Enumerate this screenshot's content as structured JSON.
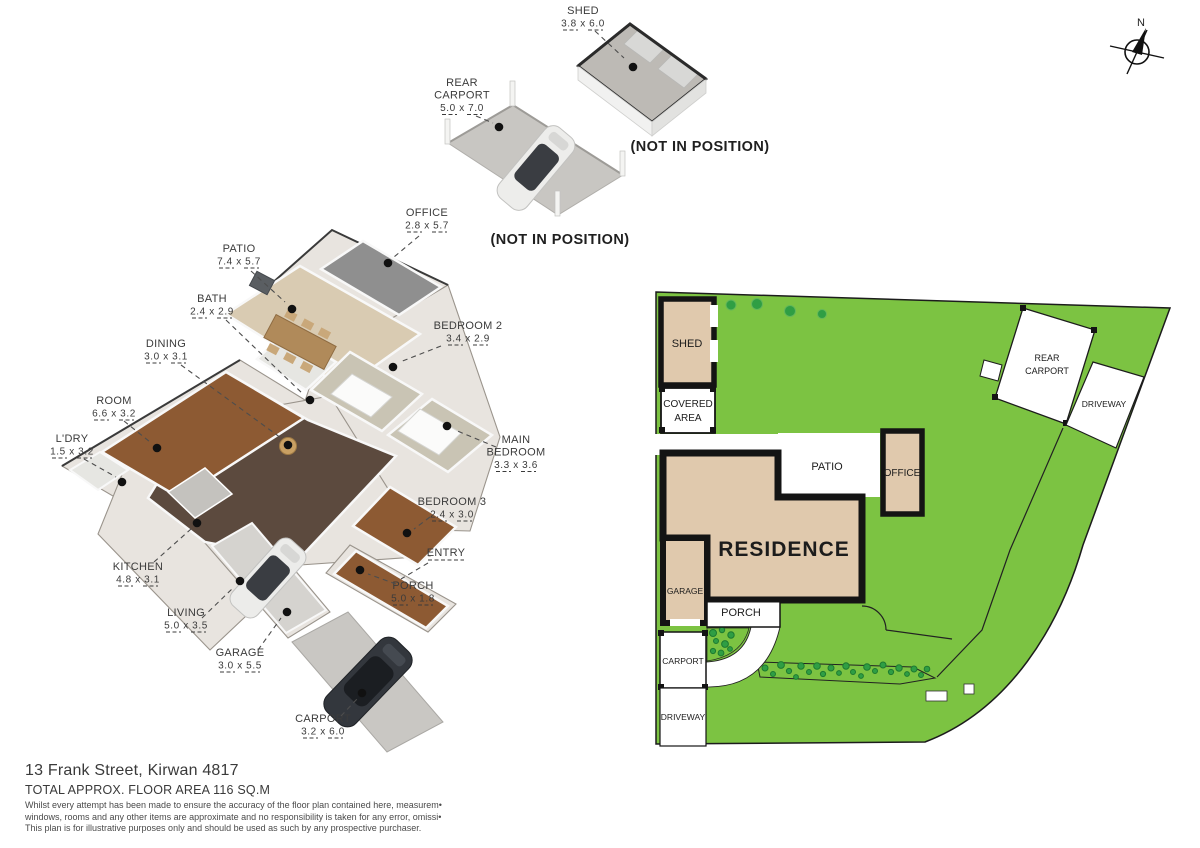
{
  "title_block": {
    "address": "13 Frank Street, Kirwan 4817",
    "floor_area": "TOTAL APPROX. FLOOR AREA 116 SQ.M",
    "disclaimer_lines": [
      "Whilst every attempt has been made to ensure the accuracy of the floor plan contained here, measurem•",
      "windows, rooms and any other items are approximate and no responsibility is taken for any error, omissi•",
      "This plan is for illustrative purposes only and should be used as such by any prospective purchaser."
    ]
  },
  "compass": {
    "label": "N"
  },
  "annotations": {
    "not_in_position_shed": "(NOT IN POSITION)",
    "not_in_position_carport": "(NOT IN POSITION)"
  },
  "floorplan_3d": {
    "labels": [
      {
        "id": "shed",
        "lines": [
          "SHED"
        ],
        "dim": "3.8 x 6.0",
        "x": 583,
        "y": 14,
        "leader": [
          595,
          31,
          624,
          58
        ],
        "dot": [
          633,
          67
        ]
      },
      {
        "id": "rear-carport",
        "lines": [
          "REAR",
          "CARPORT"
        ],
        "dim": "5.0 x 7.0",
        "x": 462,
        "y": 86,
        "leader": [
          476,
          116,
          493,
          123
        ],
        "dot": [
          499,
          127
        ]
      },
      {
        "id": "office",
        "lines": [
          "OFFICE"
        ],
        "dim": "2.8 x 5.7",
        "x": 427,
        "y": 216,
        "leader": [
          419,
          236,
          394,
          257
        ],
        "dot": [
          388,
          263
        ]
      },
      {
        "id": "patio",
        "lines": [
          "PATIO"
        ],
        "dim": "7.4 x 5.7",
        "x": 239,
        "y": 252,
        "leader": [
          251,
          271,
          285,
          302
        ],
        "dot": [
          292,
          309
        ]
      },
      {
        "id": "bath",
        "lines": [
          "BATH"
        ],
        "dim": "2.4 x 2.9",
        "x": 212,
        "y": 302,
        "leader": [
          226,
          320,
          303,
          394
        ],
        "dot": [
          310,
          400
        ]
      },
      {
        "id": "dining",
        "lines": [
          "DINING"
        ],
        "dim": "3.0 x 3.1",
        "x": 166,
        "y": 347,
        "leader": [
          181,
          365,
          281,
          438
        ],
        "dot": [
          288,
          445
        ]
      },
      {
        "id": "bedroom2",
        "lines": [
          "BEDROOM 2"
        ],
        "dim": "3.4 x 2.9",
        "x": 468,
        "y": 329,
        "leader": [
          441,
          346,
          400,
          362
        ],
        "dot": [
          393,
          367
        ]
      },
      {
        "id": "room",
        "lines": [
          "ROOM"
        ],
        "dim": "6.6 x 3.2",
        "x": 114,
        "y": 404,
        "leader": [
          124,
          421,
          150,
          442
        ],
        "dot": [
          157,
          448
        ]
      },
      {
        "id": "ldry",
        "lines": [
          "L'DRY"
        ],
        "dim": "1.5 x 3.2",
        "x": 72,
        "y": 442,
        "leader": [
          84,
          459,
          116,
          477
        ],
        "dot": [
          122,
          482
        ]
      },
      {
        "id": "main-bedroom",
        "lines": [
          "MAIN",
          "BEDROOM"
        ],
        "dim": "3.3 x 3.6",
        "x": 516,
        "y": 443,
        "leader": [
          496,
          447,
          455,
          430
        ],
        "dot": [
          447,
          426
        ]
      },
      {
        "id": "bedroom3",
        "lines": [
          "BEDROOM 3"
        ],
        "dim": "2.4 x 3.0",
        "x": 452,
        "y": 505,
        "leader": [
          430,
          517,
          414,
          529
        ],
        "dot": [
          407,
          533
        ]
      },
      {
        "id": "entry",
        "lines": [
          "ENTRY"
        ],
        "dim": null,
        "underline": true,
        "x": 446,
        "y": 556,
        "leader": [
          428,
          563,
          401,
          579
        ],
        "dot": null
      },
      {
        "id": "porch",
        "lines": [
          "PORCH"
        ],
        "dim": "5.0 x 1.8",
        "x": 413,
        "y": 589,
        "leader": [
          396,
          584,
          368,
          574
        ],
        "dot": [
          360,
          570
        ]
      },
      {
        "id": "kitchen",
        "lines": [
          "KITCHEN"
        ],
        "dim": "4.8 x 3.1",
        "x": 138,
        "y": 570,
        "leader": [
          154,
          562,
          191,
          529
        ],
        "dot": [
          197,
          523
        ]
      },
      {
        "id": "living",
        "lines": [
          "LIVING"
        ],
        "dim": "5.0 x 3.5",
        "x": 186,
        "y": 616,
        "leader": [
          202,
          618,
          234,
          587
        ],
        "dot": [
          240,
          581
        ]
      },
      {
        "id": "garage",
        "lines": [
          "GARAGE"
        ],
        "dim": "3.0 x 5.5",
        "x": 240,
        "y": 656,
        "leader": [
          258,
          650,
          281,
          618
        ],
        "dot": [
          287,
          612
        ]
      },
      {
        "id": "carport",
        "lines": [
          "CARPORT"
        ],
        "dim": "3.2 x 6.0",
        "x": 323,
        "y": 722,
        "leader": [
          341,
          716,
          357,
          699
        ],
        "dot": [
          362,
          693
        ]
      }
    ]
  },
  "site_plan": {
    "labels": {
      "shed": "SHED",
      "covered_area": [
        "COVERED",
        "AREA"
      ],
      "patio": "PATIO",
      "office": "OFFICE",
      "residence": "RESIDENCE",
      "garage": "GARAGE",
      "porch": "PORCH",
      "carport": "CARPORT",
      "driveway": "DRIVEWAY",
      "rear_carport": [
        "REAR",
        "CARPORT"
      ],
      "rear_driveway": "DRIVEWAY"
    },
    "colors": {
      "lawn": "#7cc342",
      "building": "#e0c9ad",
      "outline": "#141414"
    },
    "tree_dots": [
      [
        731,
        305,
        5
      ],
      [
        757,
        304,
        5.5
      ],
      [
        790,
        311,
        5.5
      ],
      [
        822,
        314,
        4.5
      ]
    ],
    "front_garden_dots": [
      [
        713,
        633,
        3.5
      ],
      [
        722,
        630,
        2.7
      ],
      [
        731,
        635,
        3.2
      ],
      [
        716,
        641,
        2.5
      ],
      [
        725,
        644,
        3.4
      ],
      [
        713,
        651,
        2.6
      ],
      [
        721,
        653,
        2.9
      ],
      [
        730,
        649,
        2.4
      ]
    ],
    "garden_dots": [
      [
        765,
        668,
        3
      ],
      [
        773,
        674,
        2.5
      ],
      [
        781,
        665,
        3.4
      ],
      [
        789,
        671,
        2.6
      ],
      [
        796,
        677,
        2.4
      ],
      [
        801,
        666,
        3.2
      ],
      [
        809,
        672,
        2.5
      ],
      [
        817,
        666,
        3.3
      ],
      [
        823,
        674,
        2.6
      ],
      [
        831,
        668,
        3
      ],
      [
        839,
        673,
        2.4
      ],
      [
        846,
        666,
        3.2
      ],
      [
        853,
        672,
        2.5
      ],
      [
        861,
        676,
        2.4
      ],
      [
        867,
        667,
        3.3
      ],
      [
        875,
        671,
        2.5
      ],
      [
        883,
        665,
        3
      ],
      [
        891,
        672,
        2.6
      ],
      [
        899,
        668,
        3.2
      ],
      [
        907,
        674,
        2.4
      ],
      [
        914,
        669,
        3
      ],
      [
        921,
        675,
        2.5
      ],
      [
        927,
        669,
        2.8
      ]
    ]
  }
}
